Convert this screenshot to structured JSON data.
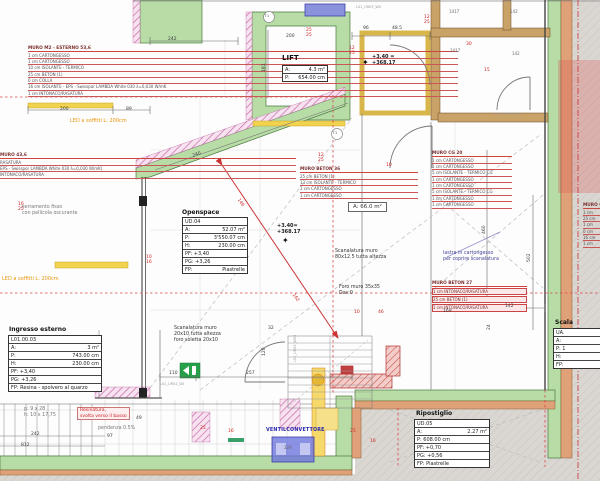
{
  "wall_specs": {
    "m2": {
      "title": "MURO  M2 - ESTERNO  53,6",
      "lines": [
        "1 cm  CARTONGESSO",
        "1 cm  CARTONGESSO",
        "10 cm  ISOLANTE - TERMICO",
        "25 cm  BETON (1)",
        "0 cm  COLLA",
        "16 cm  ISOLANTE - EPS - Swisspor LAMBDA White 030 λ=0,030 W/mK",
        "1 cm  INTONACO/RASATURA"
      ]
    },
    "m43": {
      "title": "MURO  43,6",
      "lines": [
        "RASATURA",
        "EPS - Swisspor LAMBDA White 030 λ=0,030 W/mK)",
        "INTONACO/RASATURA"
      ]
    },
    "beton36": {
      "title": "MURO  BETON 36",
      "lines": [
        "25 cm  BETON (1)",
        "13 cm  ISOLANTE - TERMICO",
        "1 cm  CARTONGESSO",
        "1 cm  CARTONGESSO"
      ]
    },
    "cg20": {
      "title": "MURO  CG 20",
      "lines": [
        "1 cm  CARTONGESSO",
        "1 cm  CARTONGESSO",
        "5 cm  ISOLANTE - TERMICO CG",
        "1 cm  CARTONGESSO",
        "1 cm  CARTONGESSO",
        "5 cm  ISOLANTE - TERMICO CG",
        "1 cm  CARTONGESSO",
        "1 cm  CARTONGESSO"
      ]
    },
    "beton27": {
      "title": "MURO  BETON 27",
      "lines": [
        "1 cm  INTONACO/RASATURA",
        "25 cm  BETON (1)",
        "1 cm  INTONACO/RASATURA"
      ]
    },
    "muro_right": {
      "title": "MURO  C",
      "lines": [
        "1 cm",
        "25 cm",
        "1 cm",
        "0 cm",
        "16 cm",
        "1 cm"
      ]
    }
  },
  "rooms": {
    "lift": {
      "title": "LIFT",
      "rows": [
        [
          "A:",
          "4.3 m²"
        ],
        [
          "P:",
          "654.00 cm"
        ]
      ]
    },
    "openspace": {
      "title": "Openspace",
      "rows": [
        [
          "UD.04",
          ""
        ],
        [
          "A:",
          "52.07 m²"
        ],
        [
          "P:",
          "3'550.07 cm"
        ],
        [
          "H:",
          "230.00 cm"
        ],
        [
          "PF: +3,40",
          ""
        ],
        [
          "PG: +3,26",
          ""
        ],
        [
          "FP:",
          "Piastrelle"
        ]
      ]
    },
    "ingresso": {
      "title": "Ingresso esterno",
      "rows": [
        [
          "L01.00.03",
          ""
        ],
        [
          "A:",
          "3 m²"
        ],
        [
          "P:",
          "743.00 cm"
        ],
        [
          "H:",
          "230.00 cm"
        ],
        [
          "PF: +3,40",
          ""
        ],
        [
          "PG: +3,26",
          ""
        ],
        [
          "FP: Resina - spolvero al quarzo",
          ""
        ]
      ]
    },
    "ripostiglio": {
      "title": "Ripostiglio",
      "rows": [
        [
          "UD.05",
          ""
        ],
        [
          "A:",
          "2.27 m²"
        ],
        [
          "P: 608.00 cm",
          ""
        ],
        [
          "PF: +0,70",
          ""
        ],
        [
          "PG: +0,56",
          ""
        ],
        [
          "FP: Piastrelle",
          ""
        ]
      ]
    },
    "scala": {
      "title": "Scala",
      "rows": [
        [
          "UA.",
          ""
        ],
        [
          "A:",
          ""
        ],
        [
          "P: 1",
          ""
        ],
        [
          "H:",
          ""
        ],
        [
          "FP:",
          ""
        ]
      ]
    },
    "area_label": "A: 66.0 m²"
  },
  "labels": [
    {
      "t": "242",
      "x": 168,
      "y": 37
    },
    {
      "t": "200",
      "x": 60,
      "y": 107
    },
    {
      "t": "89",
      "x": 126,
      "y": 107
    },
    {
      "t": "240",
      "x": 192,
      "y": 154,
      "r": -19
    },
    {
      "t": "200",
      "x": 286,
      "y": 34
    },
    {
      "t": "181",
      "x": 262,
      "y": 72,
      "r": -90
    },
    {
      "t": "96",
      "x": 363,
      "y": 26
    },
    {
      "t": "48.5",
      "x": 392,
      "y": 26
    },
    {
      "t": "460",
      "x": 482,
      "y": 234,
      "r": -90
    },
    {
      "t": "502",
      "x": 527,
      "y": 262,
      "r": -90
    },
    {
      "t": "169",
      "x": 443,
      "y": 309
    },
    {
      "t": "142",
      "x": 505,
      "y": 304
    },
    {
      "t": "24",
      "x": 487,
      "y": 330,
      "r": -90
    },
    {
      "t": "110",
      "x": 169,
      "y": 371
    },
    {
      "t": "257",
      "x": 246,
      "y": 371
    },
    {
      "t": "32",
      "x": 268,
      "y": 326
    },
    {
      "t": "120",
      "x": 262,
      "y": 356,
      "r": -90
    },
    {
      "t": "49",
      "x": 136,
      "y": 416
    },
    {
      "t": "97",
      "x": 107,
      "y": 434
    },
    {
      "t": "242",
      "x": 31,
      "y": 432
    },
    {
      "t": "812",
      "x": 21,
      "y": 443
    },
    {
      "t": "12\n25",
      "x": 349,
      "y": 46,
      "c": "red"
    },
    {
      "t": "25\n25",
      "x": 306,
      "y": 28,
      "c": "red"
    },
    {
      "t": "12\n25",
      "x": 424,
      "y": 15,
      "c": "red"
    },
    {
      "t": "30",
      "x": 466,
      "y": 42,
      "c": "red"
    },
    {
      "t": "15",
      "x": 484,
      "y": 68,
      "c": "red"
    },
    {
      "t": "12\n25",
      "x": 318,
      "y": 153,
      "c": "red"
    },
    {
      "t": "16\n25",
      "x": 18,
      "y": 202,
      "c": "red"
    },
    {
      "t": "10\n16",
      "x": 146,
      "y": 255,
      "c": "red"
    },
    {
      "t": "10",
      "x": 354,
      "y": 310,
      "c": "red"
    },
    {
      "t": "46",
      "x": 378,
      "y": 310,
      "c": "red"
    },
    {
      "t": "10",
      "x": 386,
      "y": 163,
      "c": "red"
    },
    {
      "t": "16",
      "x": 228,
      "y": 429,
      "c": "red"
    },
    {
      "t": "25",
      "x": 200,
      "y": 426,
      "c": "red"
    },
    {
      "t": "25",
      "x": 350,
      "y": 429,
      "c": "red"
    },
    {
      "t": "16",
      "x": 370,
      "y": 439,
      "c": "red"
    },
    {
      "t": "146",
      "x": 240,
      "y": 198,
      "c": "red",
      "r": 56
    },
    {
      "t": "162",
      "x": 295,
      "y": 293,
      "c": "red",
      "r": 56
    },
    {
      "t": "L01_UR03_W0",
      "x": 356,
      "y": 5,
      "c": "tiny"
    },
    {
      "t": "L01_UR05_W05",
      "x": 494,
      "y": 112,
      "c": "tiny"
    },
    {
      "t": "L01_UR02_D0",
      "x": 160,
      "y": 382,
      "c": "tiny"
    },
    {
      "t": "L01_UR02_W03",
      "x": 293,
      "y": 362,
      "c": "tiny",
      "r": -90
    },
    {
      "t": "1417",
      "x": 449,
      "y": 10,
      "c": "tinyd"
    },
    {
      "t": "142",
      "x": 510,
      "y": 10,
      "c": "tinyd"
    },
    {
      "t": "1417",
      "x": 450,
      "y": 49,
      "c": "tinyd"
    },
    {
      "t": "142",
      "x": 512,
      "y": 52,
      "c": "tinyd"
    },
    {
      "t": "serramento fisso\ncon pellicola oscurante",
      "x": 22,
      "y": 205,
      "c": "note g"
    },
    {
      "t": "LED a soffitti L: 200cm",
      "x": 70,
      "y": 118,
      "c": "orange"
    },
    {
      "t": "LED a soffitti L: 200cm",
      "x": 2,
      "y": 276,
      "c": "orange"
    },
    {
      "t": "Scanalatura muro\n80x12.5 tutta altezza",
      "x": 335,
      "y": 249,
      "c": "note"
    },
    {
      "t": "Foro muro 35x35\nDav:0",
      "x": 339,
      "y": 285,
      "c": "note"
    },
    {
      "t": "Scanalatura muro\n20x10 tutta altezza\nforo soletta 20x10",
      "x": 174,
      "y": 326,
      "c": "note"
    },
    {
      "t": "lastra in cartongesso\nper coprire scanalatura",
      "x": 443,
      "y": 251,
      "c": "note b"
    },
    {
      "t": "pendenza 0.5%",
      "x": 98,
      "y": 426,
      "c": "note g"
    },
    {
      "t": "p: 9 x 28\nh: 10 x 17,75",
      "x": 24,
      "y": 407,
      "c": "note g"
    },
    {
      "t": "VENTILCONVETTORE",
      "x": 266,
      "y": 428,
      "c": "blue"
    },
    {
      "t": "+3.40 =\n+368.17",
      "x": 372,
      "y": 54,
      "c": "elev"
    },
    {
      "t": "+3.40=\n+368.17",
      "x": 277,
      "y": 223,
      "c": "elev"
    },
    {
      "t": "✦",
      "x": 362,
      "y": 58,
      "c": "star"
    },
    {
      "t": "✦",
      "x": 282,
      "y": 236,
      "c": "star"
    },
    {
      "t": "T1",
      "x": 264.5,
      "y": 13.5,
      "c": "circ"
    },
    {
      "t": "T1",
      "x": 332.5,
      "y": 130.5,
      "c": "circ"
    },
    {
      "t": "Resinatura,\nsvolta verso il basso",
      "x": 77,
      "y": 407,
      "c": "redbox"
    },
    {
      "t": "229",
      "x": 284,
      "y": 446,
      "c": "tinyd"
    }
  ],
  "colors": {
    "wall_green": "#b7dca6",
    "wall_salmon": "#e0a178",
    "wall_tan": "#c9a268",
    "hatch_pink": "#c86aaa",
    "concrete": "#dad7d2",
    "dim_red": "#cc3333",
    "highlight_yellow": "#f1d34d",
    "fixture_blue": "#8a92dd",
    "exit_green": "#27a04a"
  }
}
